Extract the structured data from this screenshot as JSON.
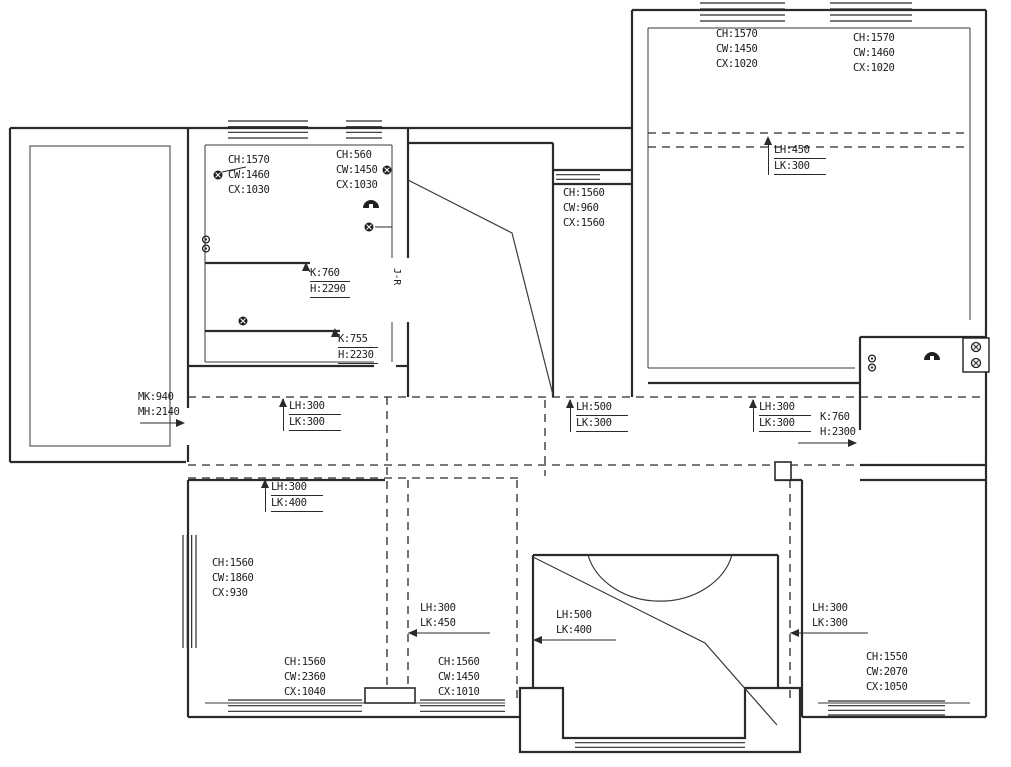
{
  "canvas": {
    "w": 1011,
    "h": 767
  },
  "colors": {
    "bg": "#ffffff",
    "wall": "#2a2a2a",
    "thin": "#3a3a3a",
    "dashed": "#2a2a2a",
    "text": "#1c1c1c",
    "symbol": "#1f1f1f"
  },
  "labels": [
    {
      "id": "room-topleft-a",
      "x": 228,
      "y": 153,
      "style": "plain",
      "lines": [
        "CH:1570",
        "CW:1460",
        "CX:1030"
      ]
    },
    {
      "id": "room-topleft-b",
      "x": 336,
      "y": 148,
      "style": "plain",
      "lines": [
        "CH:560",
        "CW:1450",
        "CX:1030"
      ]
    },
    {
      "id": "mid-window",
      "x": 563,
      "y": 186,
      "style": "plain",
      "lines": [
        "CH:1560",
        "CW:960",
        "CX:1560"
      ]
    },
    {
      "id": "room-topright-a",
      "x": 716,
      "y": 27,
      "style": "plain",
      "lines": [
        "CH:1570",
        "CW:1450",
        "CX:1020"
      ]
    },
    {
      "id": "room-topright-b",
      "x": 853,
      "y": 31,
      "style": "plain",
      "lines": [
        "CH:1570",
        "CW:1460",
        "CX:1020"
      ]
    },
    {
      "id": "beam-topright",
      "x": 768,
      "y": 143,
      "style": "bracket",
      "lines": [
        "LH:450",
        "LK:300"
      ]
    },
    {
      "id": "opening-k760-h2290",
      "x": 310,
      "y": 266,
      "style": "boxed",
      "lines": [
        "K:760",
        "H:2290"
      ]
    },
    {
      "id": "opening-k755-h2230",
      "x": 338,
      "y": 332,
      "style": "boxed",
      "lines": [
        "K:755",
        "H:2230"
      ]
    },
    {
      "id": "door-mk940",
      "x": 138,
      "y": 390,
      "style": "plain",
      "lines": [
        "MK:940",
        "MH:2140"
      ]
    },
    {
      "id": "beam-corridor-left",
      "x": 283,
      "y": 399,
      "style": "bracket",
      "lines": [
        "LH:300",
        "LK:300"
      ]
    },
    {
      "id": "beam-corridor-mid",
      "x": 570,
      "y": 400,
      "style": "bracket",
      "lines": [
        "LH:500",
        "LK:300"
      ]
    },
    {
      "id": "beam-corridor-right",
      "x": 753,
      "y": 400,
      "style": "bracket",
      "lines": [
        "LH:300",
        "LK:300"
      ]
    },
    {
      "id": "opening-k760-h2300",
      "x": 820,
      "y": 410,
      "style": "plain",
      "lines": [
        "K:760",
        "H:2300"
      ]
    },
    {
      "id": "beam-lower-left",
      "x": 265,
      "y": 480,
      "style": "bracket",
      "lines": [
        "LH:300",
        "LK:400"
      ]
    },
    {
      "id": "room-bottomleft-a",
      "x": 212,
      "y": 556,
      "style": "plain",
      "lines": [
        "CH:1560",
        "CW:1860",
        "CX:930"
      ]
    },
    {
      "id": "beam-bottom-a",
      "x": 420,
      "y": 601,
      "style": "plain",
      "lines": [
        "LH:300",
        "LK:450"
      ]
    },
    {
      "id": "beam-bottom-b",
      "x": 556,
      "y": 608,
      "style": "plain",
      "lines": [
        "LH:500",
        "LK:400"
      ]
    },
    {
      "id": "beam-bottom-c",
      "x": 812,
      "y": 601,
      "style": "plain",
      "lines": [
        "LH:300",
        "LK:300"
      ]
    },
    {
      "id": "room-bottomleft-b",
      "x": 284,
      "y": 655,
      "style": "plain",
      "lines": [
        "CH:1560",
        "CW:2360",
        "CX:1040"
      ]
    },
    {
      "id": "room-bottommid",
      "x": 438,
      "y": 655,
      "style": "plain",
      "lines": [
        "CH:1560",
        "CW:1450",
        "CX:1010"
      ]
    },
    {
      "id": "room-bottomright",
      "x": 866,
      "y": 650,
      "style": "plain",
      "lines": [
        "CH:1550",
        "CW:2070",
        "CX:1050"
      ]
    },
    {
      "id": "door-marker-jr",
      "x": 404,
      "y": 268,
      "style": "vertical",
      "lines": [
        "J-R"
      ]
    }
  ],
  "geometry": {
    "walls": [
      "M10,128 L632,128",
      "M10,128 L10,462",
      "M10,462 L186,462",
      "M188,128 L188,408",
      "M188,445 L188,462",
      "M632,128 L632,10",
      "M632,10 L986,10",
      "M986,10 L986,717",
      "M632,128 L632,397",
      "M408,128 L408,258",
      "M408,322 L408,397",
      "M408,143 L553,143",
      "M553,143 L553,397",
      "M553,170 L632,170",
      "M553,184 L632,184",
      "M188,366 L374,366",
      "M396,366 L408,366",
      "M205,263 L310,263",
      "M205,331 L340,331",
      "M648,383 L860,383",
      "M860,337 L986,337",
      "M860,337 L860,430",
      "M860,465 L986,465",
      "M188,480 L385,480",
      "M775,480 L802,480",
      "M860,480 L986,480",
      "M188,480 L188,717",
      "M188,717 L520,717",
      "M533,688 L520,688 L520,752 L800,752 L800,688 L778,688",
      "M533,688 L563,688 L563,738 L745,738 L745,688 L778,688",
      "M802,480 L802,717",
      "M802,717 L986,717",
      "M533,555 L778,555",
      "M533,555 L533,688",
      "M778,555 L778,688"
    ],
    "thin": [
      "M30,146 L170,146 L170,446 L30,446 Z",
      "M205,145 L392,145",
      "M205,145 L205,362",
      "M392,145 L392,258",
      "M392,322 L392,362",
      "M205,362 L374,362",
      "M648,28 L970,28",
      "M648,28 L648,368",
      "M970,28 L970,320",
      "M648,368 L855,368",
      "M205,703 L505,703",
      "M818,703 L970,703"
    ],
    "dashed": [
      "M188,397 L986,397",
      "M188,465 L986,465",
      "M188,478 L520,478",
      "M648,133 L970,133",
      "M648,147 L970,147",
      "M387,397 L387,700",
      "M408,480 L408,700",
      "M517,480 L517,700",
      "M545,400 L545,476",
      "M790,480 L790,700"
    ],
    "diagonals": [
      "M408,180 L512,233 L553,395",
      "M533,557 L705,643 L777,725"
    ],
    "arcs": [
      "M588,555 A74,60 0 0 0 732,555"
    ],
    "windows": [
      {
        "o": "h",
        "x": 228,
        "y": 121,
        "w": 80,
        "h": 17
      },
      {
        "o": "h",
        "x": 346,
        "y": 121,
        "w": 36,
        "h": 17
      },
      {
        "o": "h",
        "x": 556,
        "y": 170,
        "w": 44,
        "h": 14
      },
      {
        "o": "h",
        "x": 700,
        "y": 3,
        "w": 85,
        "h": 18
      },
      {
        "o": "h",
        "x": 830,
        "y": 3,
        "w": 82,
        "h": 18
      },
      {
        "o": "h",
        "x": 228,
        "y": 700,
        "w": 134,
        "h": 17
      },
      {
        "o": "h",
        "x": 420,
        "y": 700,
        "w": 85,
        "h": 17
      },
      {
        "o": "h",
        "x": 575,
        "y": 738,
        "w": 170,
        "h": 14
      },
      {
        "o": "h",
        "x": 828,
        "y": 701,
        "w": 117,
        "h": 14
      },
      {
        "o": "v",
        "x": 183,
        "y": 535,
        "w": 13,
        "h": 113
      }
    ],
    "piers": [
      {
        "x": 775,
        "y": 462,
        "w": 16,
        "h": 18
      },
      {
        "x": 365,
        "y": 688,
        "w": 50,
        "h": 15
      }
    ],
    "leaders": [
      "M140,423 L183,423",
      "M798,443 L855,443",
      "M408,633 L490,633",
      "M533,640 L616,640",
      "M790,633 L868,633",
      "M222,172 L246,167",
      "M375,227 L392,227",
      "M306,264 L310,272",
      "M335,330 L339,336"
    ]
  },
  "arrows": [
    {
      "x": 283,
      "y": 398,
      "dir": "up"
    },
    {
      "x": 570,
      "y": 399,
      "dir": "up"
    },
    {
      "x": 753,
      "y": 399,
      "dir": "up"
    },
    {
      "x": 768,
      "y": 136,
      "dir": "up"
    },
    {
      "x": 265,
      "y": 479,
      "dir": "up"
    },
    {
      "x": 306,
      "y": 262,
      "dir": "up"
    },
    {
      "x": 335,
      "y": 328,
      "dir": "up"
    },
    {
      "x": 185,
      "y": 423,
      "dir": "right"
    },
    {
      "x": 857,
      "y": 443,
      "dir": "right"
    },
    {
      "x": 408,
      "y": 633,
      "dir": "left"
    },
    {
      "x": 533,
      "y": 640,
      "dir": "left"
    },
    {
      "x": 790,
      "y": 633,
      "dir": "left"
    }
  ],
  "symbols": [
    {
      "t": "socket",
      "x": 218,
      "y": 175
    },
    {
      "t": "dsocket",
      "x": 206,
      "y": 244
    },
    {
      "t": "socket",
      "x": 387,
      "y": 170
    },
    {
      "t": "light",
      "x": 371,
      "y": 205
    },
    {
      "t": "socket",
      "x": 369,
      "y": 227
    },
    {
      "t": "socket",
      "x": 243,
      "y": 321
    },
    {
      "t": "dsocket",
      "x": 872,
      "y": 363
    },
    {
      "t": "light",
      "x": 932,
      "y": 357
    },
    {
      "t": "switchbox",
      "x": 963,
      "y": 338
    }
  ]
}
